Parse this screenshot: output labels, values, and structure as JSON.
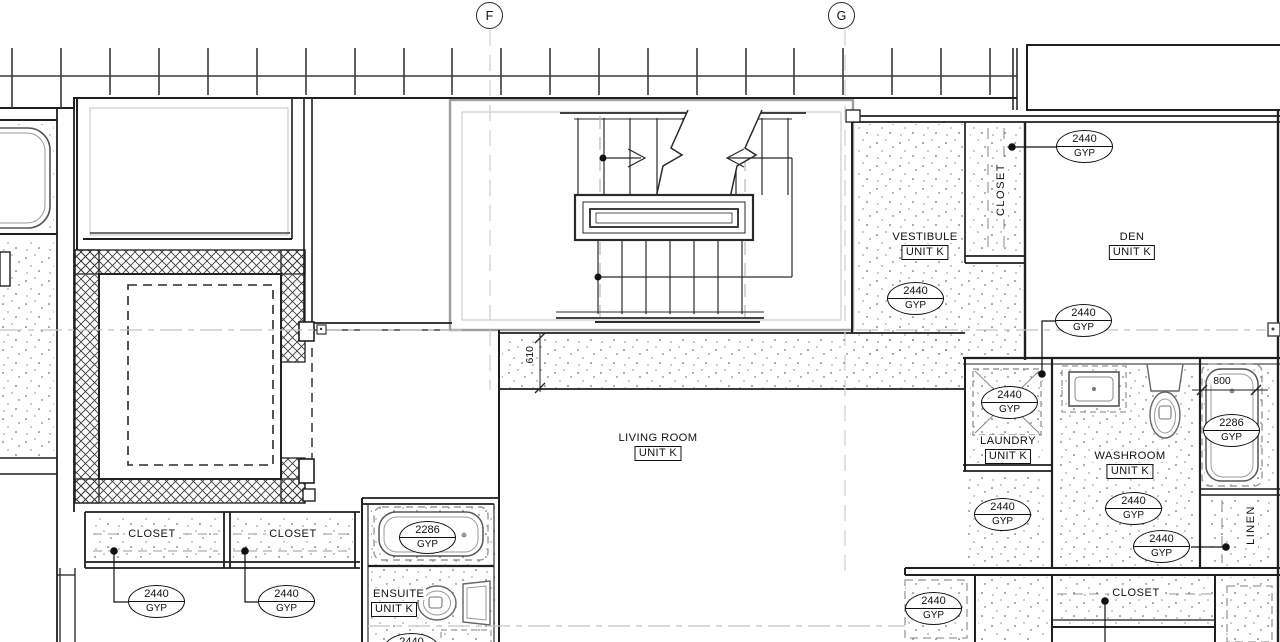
{
  "plan": {
    "grid_markers": [
      {
        "label": "F"
      },
      {
        "label": "G"
      }
    ],
    "rooms": [
      {
        "name": "VESTIBULE",
        "unit": "UNIT K"
      },
      {
        "name": "DEN",
        "unit": "UNIT K"
      },
      {
        "name": "LIVING ROOM",
        "unit": "UNIT K"
      },
      {
        "name": "LAUNDRY",
        "unit": "UNIT K"
      },
      {
        "name": "WASHROOM",
        "unit": "UNIT K"
      },
      {
        "name": "ENSUITE",
        "unit": "UNIT K"
      }
    ],
    "closet_labels": [
      {
        "label": "CLOSET"
      },
      {
        "label": "CLOSET"
      },
      {
        "label": "CLOSET"
      },
      {
        "label": "LINEN"
      },
      {
        "label": "CLOSET"
      }
    ],
    "ceiling_height_tags": [
      {
        "value": "2440",
        "material": "GYP"
      },
      {
        "value": "2440",
        "material": "GYP"
      },
      {
        "value": "2440",
        "material": "GYP"
      },
      {
        "value": "2440",
        "material": "GYP"
      },
      {
        "value": "2440",
        "material": "GYP"
      },
      {
        "value": "2440",
        "material": "GYP"
      },
      {
        "value": "2440",
        "material": "GYP"
      },
      {
        "value": "2286",
        "material": "GYP"
      },
      {
        "value": "2440",
        "material": "GYP"
      },
      {
        "value": "2440",
        "material": "GYP"
      },
      {
        "value": "2286",
        "material": "GYP"
      },
      {
        "value": "2440",
        "material": "GYP"
      },
      {
        "value": "2440",
        "material": "GYP"
      }
    ],
    "dimensions": [
      {
        "value": "610"
      },
      {
        "value": "800"
      }
    ]
  }
}
